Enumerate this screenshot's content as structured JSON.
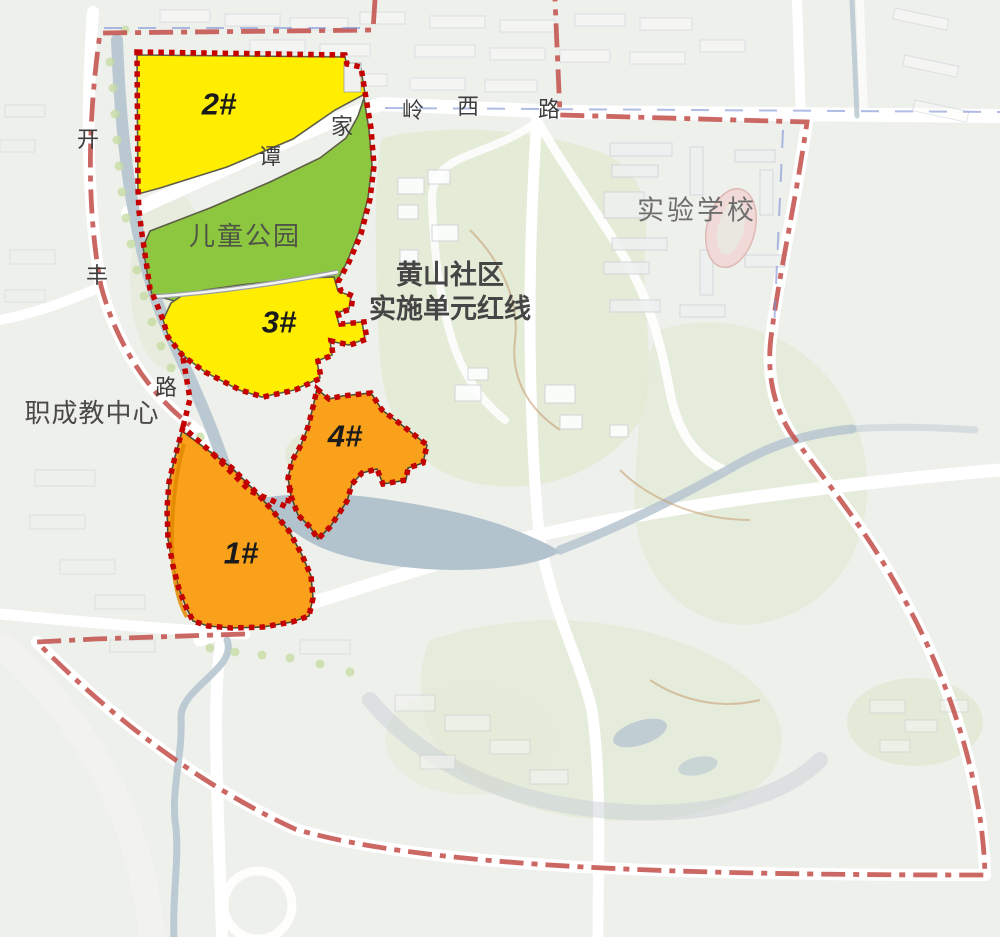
{
  "map": {
    "redline_label": {
      "line1": "黄山社区",
      "line2": "实施单元红线"
    },
    "parcels": {
      "p1": {
        "label": "1#"
      },
      "p2": {
        "label": "2#"
      },
      "p3": {
        "label": "3#"
      },
      "p4": {
        "label": "4#"
      },
      "park": {
        "label": "儿童公园"
      }
    },
    "places": {
      "school": "实验学校",
      "vocational_center": "职成教中心"
    },
    "roads": {
      "kaifeng_road": {
        "name": "开丰路",
        "chars": [
          "开",
          "丰",
          "路"
        ]
      },
      "tanjialing_west_road": {
        "name": "谭家岭西路",
        "chars": [
          "谭",
          "家",
          "岭",
          "西",
          "路"
        ]
      }
    },
    "colors": {
      "parcel_yellow": "#ffee00",
      "parcel_orange": "#f9a11b",
      "park_green": "#8dc63f",
      "unit_redline": "#c40000",
      "outer_boundary": "#c4534e",
      "water": "#b6c6d0",
      "hill_green": "#e2ead4",
      "label_dark": "#1b1b1b",
      "road_text_gray": "#3e3e3e"
    }
  }
}
